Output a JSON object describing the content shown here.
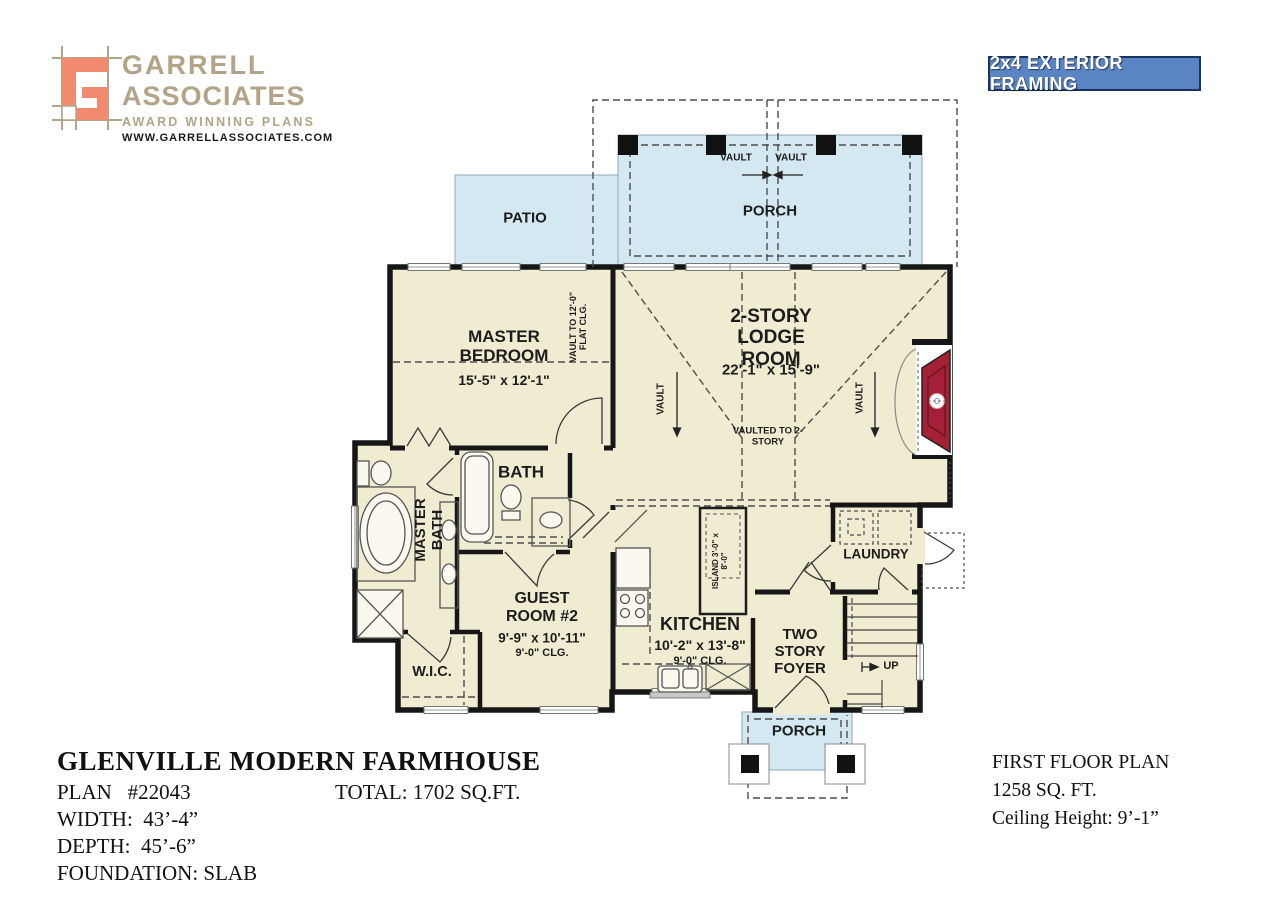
{
  "header": {
    "logo": {
      "name_line1": "GARRELL",
      "name_line2": "ASSOCIATES",
      "tagline": "AWARD WINNING PLANS",
      "website": "WWW.GARRELLASSOCIATES.COM"
    },
    "framing_badge": "2x4 EXTERIOR FRAMING"
  },
  "colors": {
    "room_fill": "#f0ecd2",
    "porch_fill": "#d4e8f2",
    "wall": "#161616",
    "fireplace_red": "#a32037",
    "badge_blue": "#5b84c4",
    "logo_coral": "#f28a70",
    "logo_tan": "#b5a588"
  },
  "plan": {
    "patio": "PATIO",
    "porch_top": "PORCH",
    "porch_bottom": "PORCH",
    "vault_porch_left": "VAULT",
    "vault_porch_right": "VAULT",
    "master_bedroom": {
      "name": "MASTER BEDROOM",
      "dims": "15'-5\" x 12'-1\""
    },
    "vault_flat": "VAULT TO 12'-0\" FLAT CLG.",
    "lodge": {
      "name": "2-STORY LODGE ROOM",
      "dims": "22'-1\" x 15'-9\""
    },
    "vault_left": "VAULT",
    "vault_right": "VAULT",
    "vaulted_two_story": "VAULTED TO 2-STORY",
    "bath": "BATH",
    "master_bath": "MASTER BATH",
    "guest_room": {
      "name": "GUEST ROOM #2",
      "dims": "9'-9\" x 10'-11\"",
      "ceiling": "9'-0\" CLG."
    },
    "kitchen": {
      "name": "KITCHEN",
      "dims": "10'-2\" x 13'-8\"",
      "ceiling": "9'-0\" CLG."
    },
    "island": "ISLAND 3'-0\" x 8'-0\"",
    "laundry": "LAUNDRY",
    "foyer": "TWO STORY FOYER",
    "up": "UP",
    "wic": "W.I.C."
  },
  "title_block": {
    "title": "GLENVILLE MODERN FARMHOUSE",
    "plan_number": "PLAN   #22043",
    "total": "TOTAL: 1702 SQ.FT.",
    "width": "WIDTH:  43’-4”",
    "depth": "DEPTH:  45’-6”",
    "foundation": "FOUNDATION: SLAB"
  },
  "floor_info": {
    "line1": "FIRST FLOOR PLAN",
    "line2": "1258 SQ. FT.",
    "line3": "Ceiling Height: 9’-1”"
  }
}
